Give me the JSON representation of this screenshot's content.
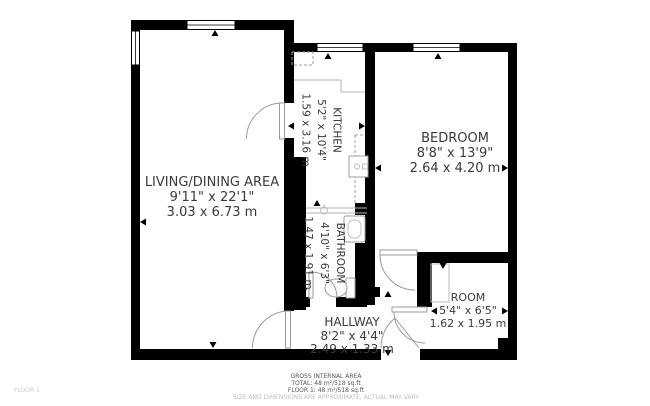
{
  "plan": {
    "rooms": [
      {
        "name": "LIVING/DINING AREA",
        "imperial": "9'11\" x 22'1\"",
        "metric": "3.03 x 6.73 m"
      },
      {
        "name": "KITCHEN",
        "imperial": "5'2\" x 10'4\"",
        "metric": "1.59 x 3.16 m"
      },
      {
        "name": "BEDROOM",
        "imperial": "8'8\" x 13'9\"",
        "metric": "2.64 x 4.20 m"
      },
      {
        "name": "BATHROOM",
        "imperial": "4'10\" x 6'3\"",
        "metric": "1.47 x 1.91 m"
      },
      {
        "name": "HALLWAY",
        "imperial": "8'2\" x 4'4\"",
        "metric": "2.49 x 1.33 m"
      },
      {
        "name": "ROOM",
        "imperial": "5'4\" x 6'5\"",
        "metric": "1.62 x 1.95 m"
      }
    ],
    "footer": {
      "title": "GROSS INTERNAL AREA",
      "total": "TOTAL: 48 m²/518 sq.ft",
      "floor": "FLOOR 1: 48 m²/518 sq.ft",
      "disclaimer": "SIZE AND DIMENSIONS ARE APPROXIMATE, ACTUAL MAY VARY"
    },
    "floor_label": "FLOOR 1",
    "colors": {
      "wall": "#000000",
      "label_text": "#3a3a3a",
      "door_arc": "#9a9a9a",
      "footer_text": "#565656",
      "disclaimer_text": "#bcbcbc",
      "floor_label_text": "#cdcdcd"
    }
  }
}
